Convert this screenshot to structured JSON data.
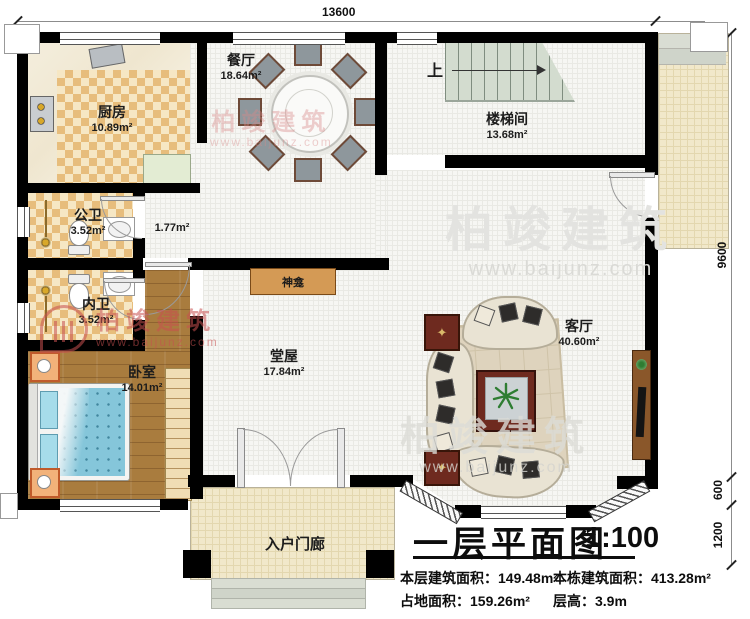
{
  "title": {
    "main": "一层平面图",
    "scale": "1:100"
  },
  "stats": {
    "row1_left_label": "本层建筑面积：",
    "row1_left_value": "149.48m²",
    "row1_right_label": "本栋建筑面积：",
    "row1_right_value": "413.28m²",
    "row2_left_label": "占地面积：",
    "row2_left_value": "159.26m²",
    "row2_right_label": "层高：",
    "row2_right_value": "3.9m"
  },
  "dimensions": {
    "top": "13600",
    "side": "9600",
    "bay": "600",
    "porch": "1200"
  },
  "rooms": {
    "kitchen": {
      "name": "厨房",
      "area": "10.89m²"
    },
    "dining": {
      "name": "餐厅",
      "area": "18.64m²"
    },
    "stairwell": {
      "name": "楼梯间",
      "area": "13.68m²"
    },
    "stair_up": "上",
    "public_bath": {
      "name": "公卫",
      "area": "3.52m²"
    },
    "corridor": {
      "area": "1.77m²"
    },
    "inner_bath": {
      "name": "内卫",
      "area": "3.52m²"
    },
    "bedroom": {
      "name": "卧室",
      "area": "14.01m²"
    },
    "hall": {
      "name": "堂屋",
      "area": "17.84m²"
    },
    "living": {
      "name": "客厅",
      "area": "40.60m²"
    },
    "shrine": {
      "name": "神龛"
    },
    "porch": {
      "name": "入户门廊"
    }
  },
  "watermark": {
    "brand": "柏竣建筑",
    "url": "www.baijunz.com"
  },
  "colors": {
    "wall": "#000000",
    "checker": "#e7bd7c",
    "wood": "#a97c3e",
    "bed": "#85c6da",
    "accent_red": "#6e2a1f"
  }
}
